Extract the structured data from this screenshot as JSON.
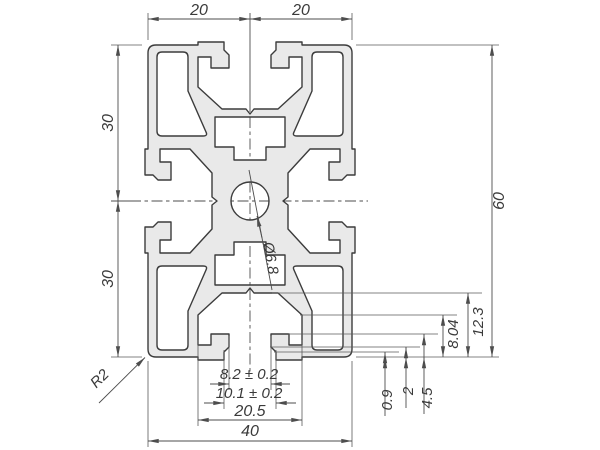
{
  "drawing": {
    "type": "technical-drawing",
    "subject": "aluminum-extrusion-profile-cross-section",
    "dimensions": {
      "top_left": "20",
      "top_right": "20",
      "left_upper": "30",
      "left_lower": "30",
      "height": "60",
      "width": "40",
      "slot_width": "20.5",
      "opening_outer": "10.1 ± 0.2",
      "opening_inner": "8.2 ± 0.2",
      "hole": "Ø6.8",
      "slot_depth": "12.3",
      "undercut": "8.04",
      "lip_depth": "4.5",
      "lip_chamfer": "2",
      "lip_step": "0.9",
      "corner_radius": "R2"
    },
    "colors": {
      "profile_fill": "#e9e9e9",
      "outline": "#3c3c3c",
      "dim_lines": "#4d4d4d",
      "background": "#ffffff"
    }
  }
}
